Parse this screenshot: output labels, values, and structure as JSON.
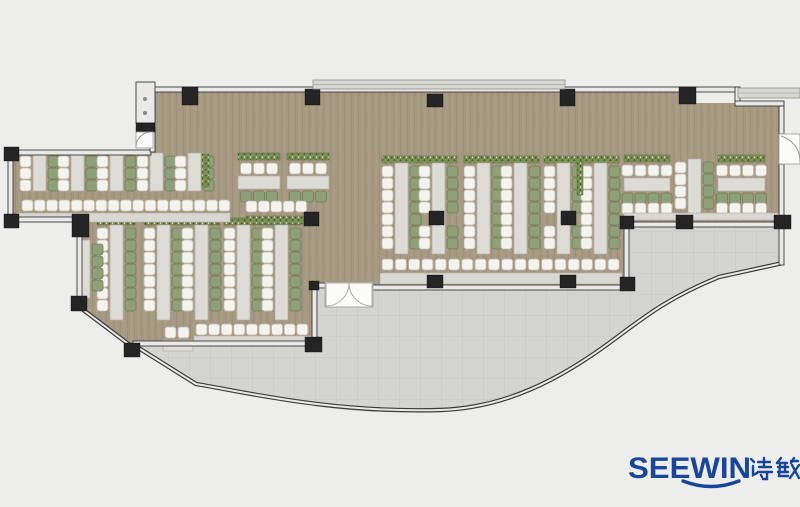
{
  "meta": {
    "description": "Top-view office canteen furniture floor plan with curved terrace"
  },
  "logo": {
    "brand": "SEEWIN",
    "cjk": "诗敏",
    "color": "#17469b"
  },
  "colors": {
    "bg": "#ededec",
    "floor": "#a79882",
    "floorGrainDark": "#8d7e67",
    "floorGrainLight": "#b8aa95",
    "terrace": "#d4d4d2",
    "terraceLine": "#c6c6c4",
    "wallFill": "#e9e9e7",
    "wallStroke": "#3b3b3b",
    "column": "#242424",
    "table": "#dcdbd5",
    "tableStroke": "#b2b0a7",
    "bench": "#d8d7d1",
    "chairW": "#f4f3ee",
    "chairWStroke": "#bcbab1",
    "chairG": "#8fa078",
    "chairGStroke": "#6e7e58",
    "hedge": "#7d9055",
    "hedgeDot": "#4c5f2e",
    "hedgeStroke": "#5f7040",
    "canopy": "#d8d8d3",
    "canopyStroke": "#90908c",
    "door": "#fbfbfa",
    "doorStroke": "#9a9a96",
    "logo": "#17469b"
  },
  "plan": {
    "floors": [
      [
        150,
        90,
        475,
        198
      ],
      [
        625,
        90,
        60,
        137
      ],
      [
        685,
        103,
        99,
        121
      ],
      [
        10,
        152,
        140,
        68
      ],
      [
        79,
        152,
        236,
        191
      ]
    ],
    "cornerMask": "77,302 77,349 134,349",
    "terrace": {
      "fill": "M314,290 L624,290 L624,226 L783,226 L783,264 L719,277 C672,296 648,314 616,338 C560,380 505,400 450,408 C395,416 330,410 290,400 C255,393 225,388 197,385 L137,347 L133,343 L314,343 Z",
      "edge": "M137,347 L196,384 C245,392 330,413 440,410 C505,408 560,380 616,338 C648,314 672,296 719,277 L783,263"
    },
    "diagWalls": [
      [
        82,
        309,
        131,
        346
      ]
    ],
    "walls": [
      [
        150,
        87,
        587,
        5
      ],
      [
        735,
        87,
        5,
        16
      ],
      [
        735,
        101,
        49,
        5
      ],
      [
        779,
        106,
        5,
        28
      ],
      [
        779,
        164,
        5,
        58
      ],
      [
        779,
        227,
        5,
        38
      ],
      [
        624,
        222,
        160,
        5
      ],
      [
        624,
        227,
        5,
        60
      ],
      [
        372,
        285,
        252,
        5
      ],
      [
        312,
        283,
        16,
        5
      ],
      [
        312,
        287,
        5,
        56
      ],
      [
        133,
        341,
        181,
        5
      ],
      [
        10,
        150,
        141,
        5
      ],
      [
        8,
        160,
        5,
        57
      ],
      [
        17,
        217,
        57,
        5
      ],
      [
        77,
        236,
        5,
        61
      ],
      [
        150,
        127,
        5,
        25
      ]
    ],
    "columns": [
      [
        182,
        87,
        16,
        18
      ],
      [
        305,
        89,
        15,
        16
      ],
      [
        427,
        94,
        16,
        13
      ],
      [
        560,
        89,
        15,
        17
      ],
      [
        679,
        87,
        17,
        17
      ],
      [
        4,
        147,
        15,
        14
      ],
      [
        4,
        214,
        15,
        14
      ],
      [
        72,
        214,
        17,
        23
      ],
      [
        71,
        296,
        16,
        15
      ],
      [
        124,
        343,
        16,
        14
      ],
      [
        305,
        337,
        17,
        15
      ],
      [
        309,
        281,
        10,
        9
      ],
      [
        427,
        275,
        16,
        13
      ],
      [
        560,
        275,
        16,
        13
      ],
      [
        620,
        277,
        15,
        14
      ],
      [
        620,
        216,
        14,
        13
      ],
      [
        676,
        215,
        17,
        14
      ],
      [
        774,
        215,
        17,
        14
      ],
      [
        429,
        211,
        15,
        14
      ],
      [
        561,
        211,
        15,
        14
      ],
      [
        304,
        212,
        15,
        14
      ]
    ],
    "canopies": [
      [
        313,
        80,
        252,
        9
      ],
      [
        738,
        88,
        62,
        10
      ]
    ],
    "shaft": {
      "box": [
        136,
        82,
        19,
        41
      ],
      "block": [
        136,
        123,
        19,
        9
      ],
      "doorway": [
        136,
        132,
        17,
        16
      ]
    },
    "furniture": {
      "verticalBanks": [
        {
          "x": 33,
          "cy": 156,
          "n": 3,
          "ty": 153,
          "th": 38
        },
        {
          "x": 71,
          "cy": 156,
          "n": 3,
          "ty": 153,
          "th": 38
        },
        {
          "x": 110,
          "cy": 156,
          "n": 3,
          "ty": 153,
          "th": 38
        },
        {
          "x": 150,
          "cy": 156,
          "n": 3,
          "ty": 153,
          "th": 38
        },
        {
          "x": 188,
          "cy": 156,
          "n": 3,
          "ty": 153,
          "th": 38
        },
        {
          "x": 110,
          "cy": 228,
          "n": 7,
          "ty": 225,
          "th": 95,
          "hy": 218
        },
        {
          "x": 157,
          "cy": 228,
          "n": 7,
          "ty": 225,
          "th": 95,
          "hy": 218
        },
        {
          "x": 195,
          "cy": 228,
          "n": 7,
          "ty": 225,
          "th": 95,
          "hy": 218
        },
        {
          "x": 237,
          "cy": 228,
          "n": 7,
          "ty": 225,
          "th": 95,
          "hy": 218
        },
        {
          "x": 275,
          "cy": 228,
          "n": 7,
          "ty": 225,
          "th": 95,
          "hy": 218
        },
        {
          "x": 395,
          "cy": 166,
          "n": 7,
          "ty": 163,
          "th": 91,
          "hy": 156
        },
        {
          "x": 432,
          "cy": 166,
          "n": 7,
          "ty": 163,
          "th": 91,
          "hy": 156,
          "skip": 4
        },
        {
          "x": 477,
          "cy": 166,
          "n": 7,
          "ty": 163,
          "th": 91,
          "hy": 156
        },
        {
          "x": 514,
          "cy": 166,
          "n": 7,
          "ty": 163,
          "th": 91,
          "hy": 156
        },
        {
          "x": 557,
          "cy": 166,
          "n": 7,
          "ty": 163,
          "th": 91,
          "hy": 156,
          "skip": 4
        },
        {
          "x": 594,
          "cy": 166,
          "n": 7,
          "ty": 163,
          "th": 91,
          "hy": 156
        },
        {
          "x": 688,
          "cy": 162,
          "n": 4,
          "ty": 159,
          "th": 56
        }
      ],
      "clusters": [
        {
          "x": 238,
          "y": 153,
          "w": 42,
          "n": 3,
          "second": false
        },
        {
          "x": 287,
          "y": 153,
          "w": 42,
          "n": 3,
          "second": false
        },
        {
          "x": 624,
          "y": 155,
          "w": 46,
          "n": 4,
          "second": true
        },
        {
          "x": 718,
          "y": 155,
          "w": 47,
          "n": 4,
          "second": true
        }
      ],
      "chairRows": [
        [
          22,
          200,
          17,
          12.3
        ],
        [
          246,
          201,
          5,
          12.4
        ],
        [
          196,
          324,
          9,
          12.6
        ],
        [
          382,
          259,
          18,
          13.3
        ],
        [
          165,
          327,
          2,
          13
        ]
      ],
      "chairCols": [
        [
          92,
          244,
          4,
          "g"
        ]
      ],
      "tables": [
        [
          79,
          240,
          11,
          58
        ],
        [
          163,
          340,
          30,
          11
        ]
      ],
      "benches": [
        [
          18,
          213,
          212,
          9
        ],
        [
          194,
          336,
          118,
          8
        ],
        [
          380,
          273,
          242,
          11
        ],
        [
          624,
          213,
          160,
          7
        ]
      ],
      "hedgesH": [
        [
          246,
          216,
          62,
          8
        ]
      ],
      "hedgesV": [
        [
          202,
          154,
          7,
          33
        ],
        [
          577,
          162,
          6,
          33
        ]
      ]
    },
    "doors": {
      "curtain": {
        "rect": [
          325,
          282,
          48,
          25
        ],
        "leafL": "M349,283 A23 23 0 0 1 326,306 L326,283 Z",
        "leafR": "M349,283 A23 23 0 0 0 372,306 L372,283 Z"
      },
      "right": {
        "rect": [
          779,
          134,
          21,
          30
        ],
        "arc": "M800,161 A26 26 0 0 0 781,136"
      },
      "shaftArc": "M136,147 A15 15 0 0 1 151,132"
    }
  }
}
